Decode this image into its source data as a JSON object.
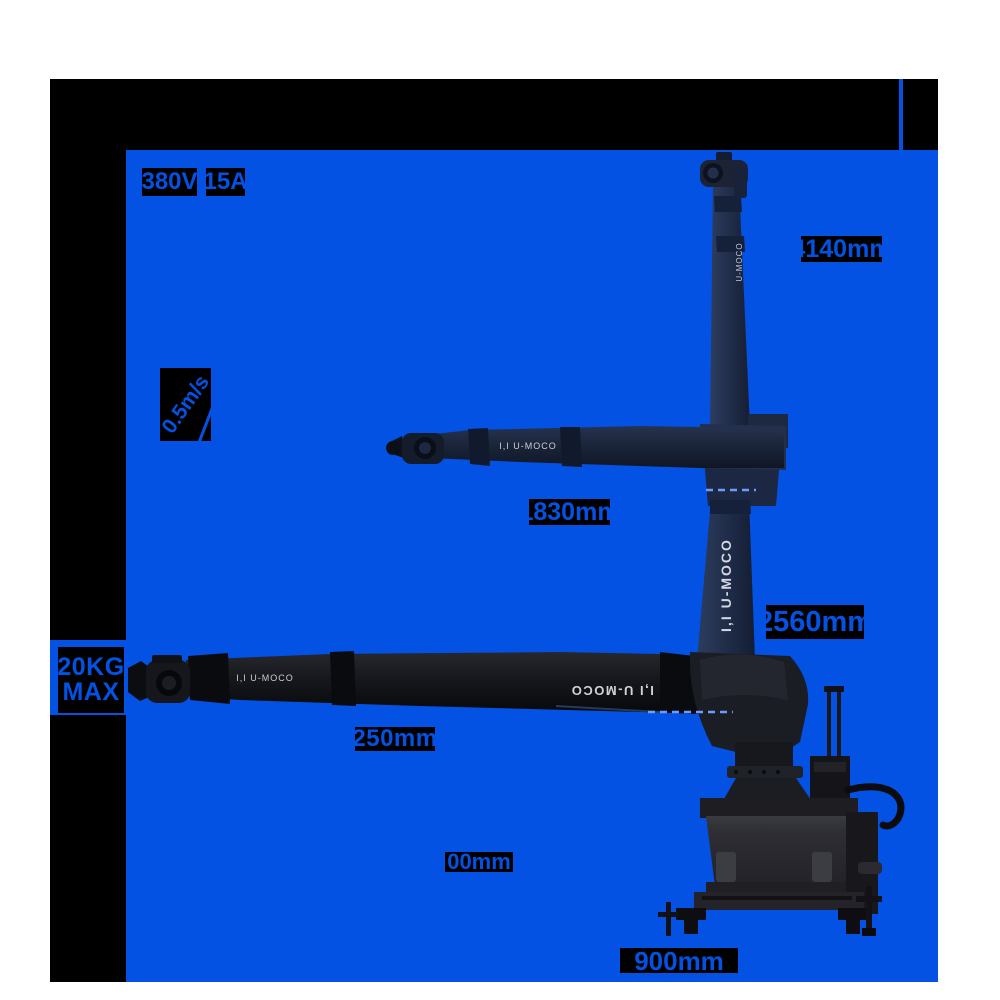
{
  "colors": {
    "panel_blue": "#0352e3",
    "block_black": "#000000",
    "page_white": "#ffffff",
    "dash_blue": "#6f9bff",
    "robot_navy": "#1f2c48",
    "robot_black": "#15171c"
  },
  "specs": {
    "voltage": "380V",
    "current": "15A",
    "speed": "0.5m/s",
    "payload_line1": "20KG",
    "payload_line2": "MAX"
  },
  "dimensions": {
    "total_height": "4140mm",
    "arm_reach": "1830mm",
    "mast_height": "2560mm",
    "lower_arm_length": "250mm",
    "base_height": "00mm",
    "base_length": "900mm"
  },
  "robot": {
    "brand": "U-MOCO",
    "brand_full": "I,I U-MOCO"
  }
}
